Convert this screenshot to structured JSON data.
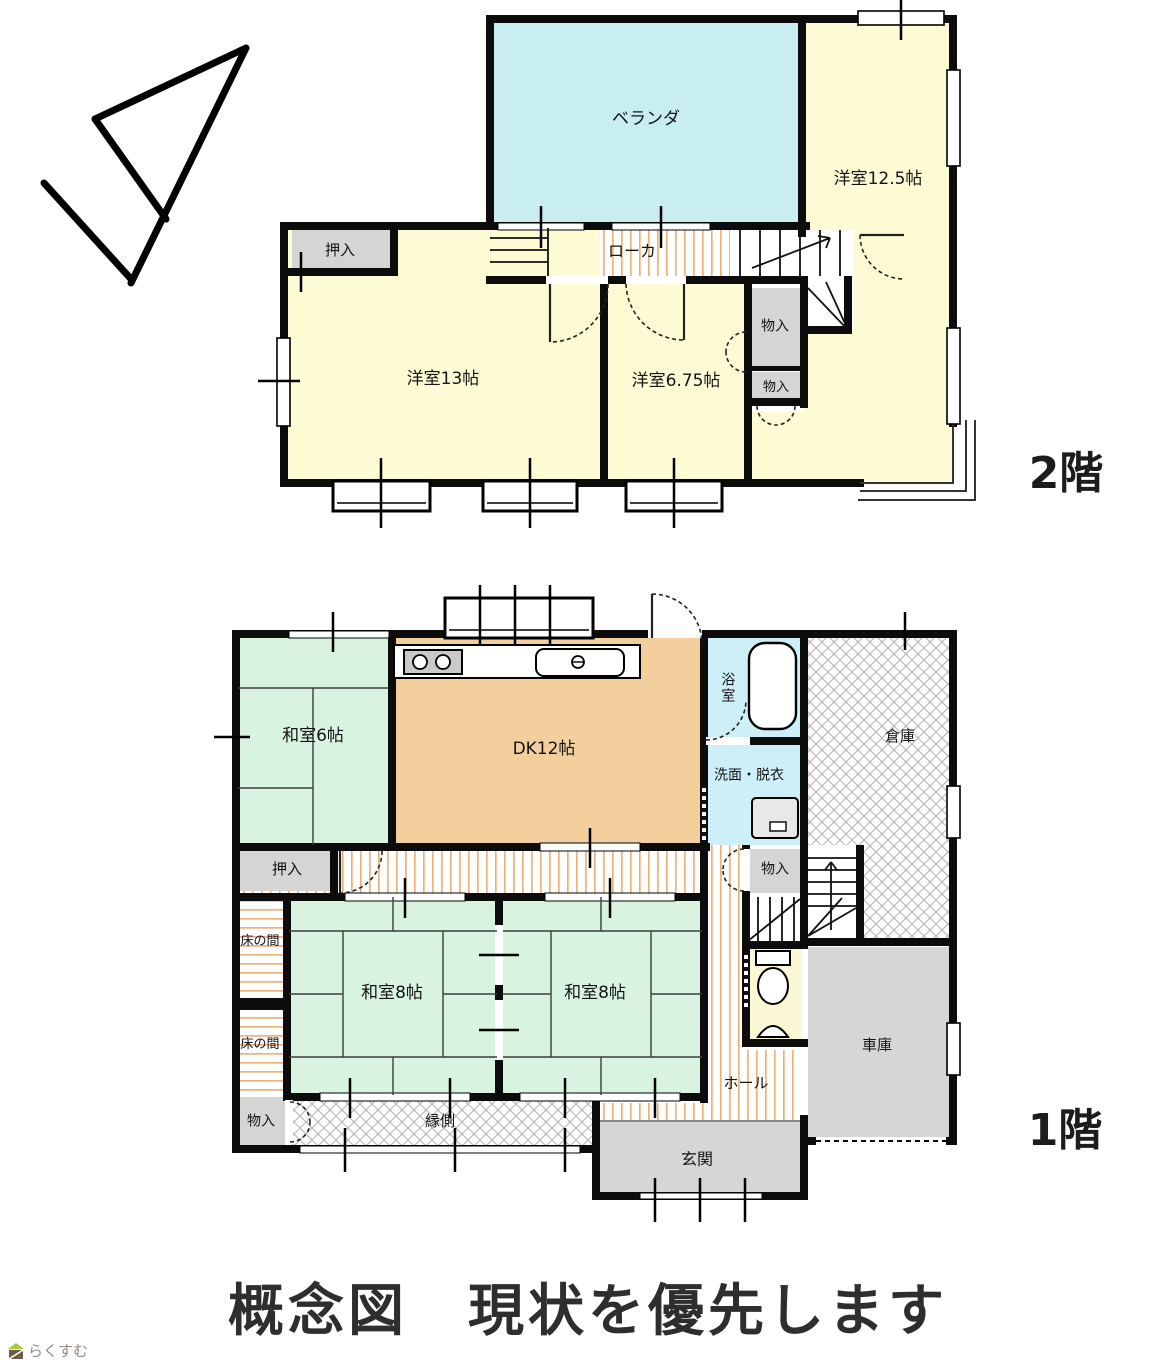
{
  "caption": {
    "title": "概念図　現状を優先します"
  },
  "footer": {
    "logo_text": "らくすむ"
  },
  "floor2": {
    "floor_label": "2階",
    "rooms": {
      "veranda": "ベランダ",
      "western_12_5": "洋室12.5帖",
      "corridor": "ローカ",
      "closet": "押入",
      "western_13": "洋室13帖",
      "western_6_75": "洋室6.75帖",
      "storage_upper": "物入",
      "storage_lower": "物入"
    }
  },
  "floor1": {
    "floor_label": "1階",
    "rooms": {
      "japanese_6": "和室6帖",
      "dk": "DK12帖",
      "bathroom": "浴室",
      "washroom": "洗面・脱衣",
      "warehouse": "倉庫",
      "closet": "押入",
      "storage_middle": "物入",
      "alcove_upper": "床の間",
      "alcove_lower": "床の間",
      "japanese_8_left": "和室8帖",
      "japanese_8_right": "和室8帖",
      "hall": "ホール",
      "garage": "車庫",
      "engawa": "縁側",
      "storage_bottom": "物入",
      "entrance": "玄関"
    }
  },
  "colors": {
    "wall": "#0c0c0c",
    "western_room": "#fcfbd4",
    "veranda": "#c9eef1",
    "bath": "#cdeff7",
    "tatami": "#d9f3e1",
    "dk": "#f3cf9e",
    "closet_gray": "#d5d5d5",
    "garage_gray": "#d6d6d6",
    "toilet_yellow": "#fbf8d6",
    "stripe_peach": "#f0b078",
    "lattice_gray": "#bcbcbc"
  }
}
